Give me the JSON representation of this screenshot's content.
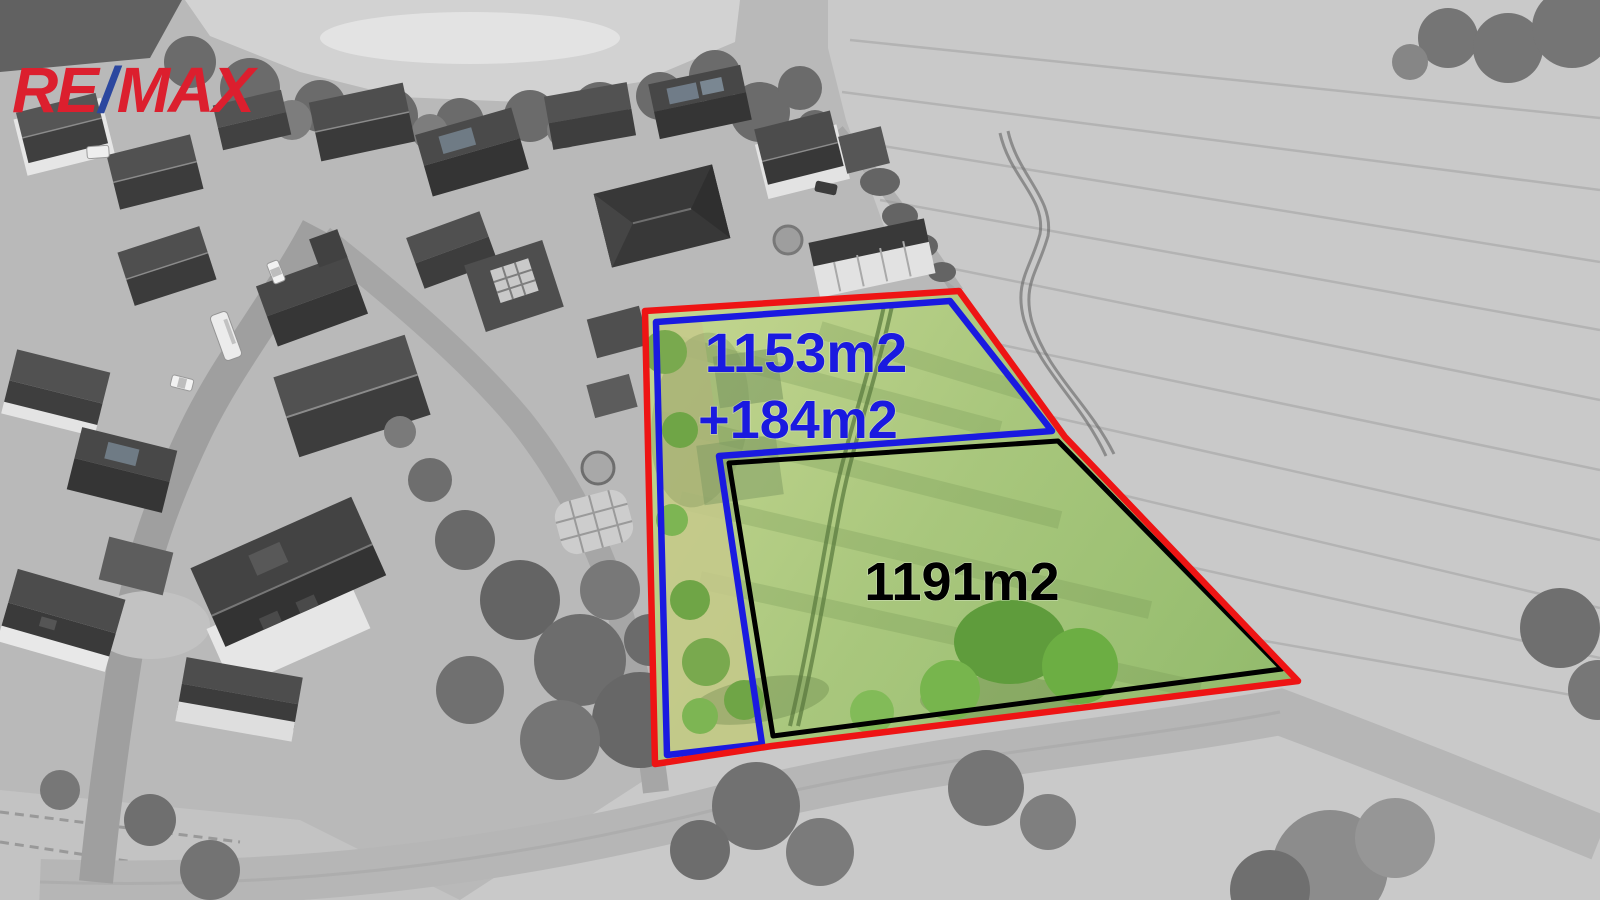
{
  "image": {
    "kind": "real-estate aerial drone photo",
    "description": "Grayscale village and field with color-highlighted building plot for sale",
    "watermark": "RE/MAX"
  },
  "logo": {
    "re": "RE",
    "slash": "/",
    "max": "MAX",
    "red": "#dc1f2e",
    "blue": "#2b479f"
  },
  "plot": {
    "labels": {
      "parcel_a_area": "1153m2",
      "parcel_a_extra": "+184m2",
      "parcel_b_area": "1191m2"
    },
    "colors": {
      "outer_boundary": "#ee1414",
      "parcel_a_outline": "#1a1ae0",
      "parcel_b_outline": "#000000",
      "highlight_grass": "#a9c77d"
    }
  }
}
